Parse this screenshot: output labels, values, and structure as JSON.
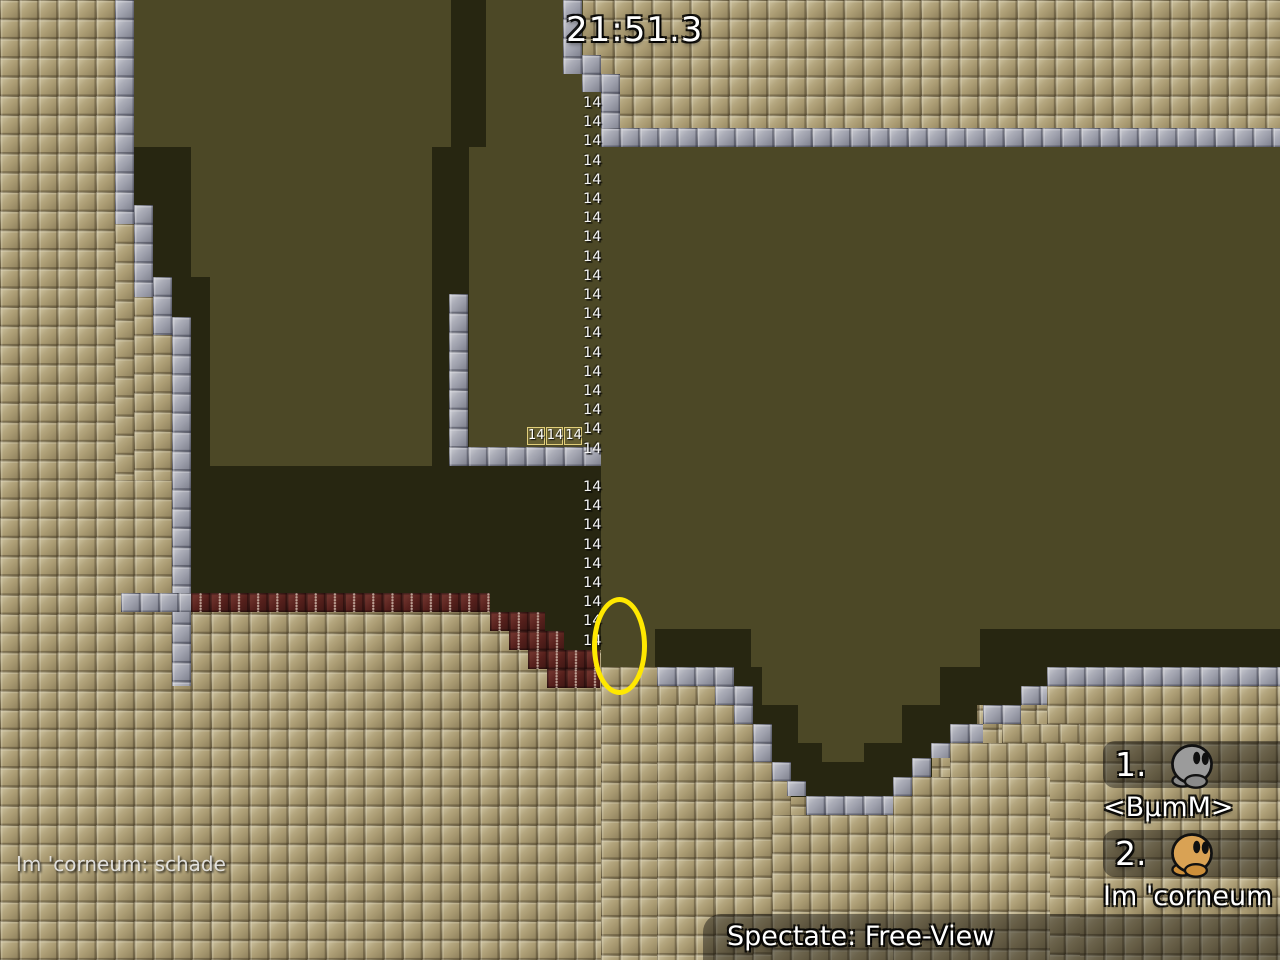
{
  "hud": {
    "timer": "21:51.3",
    "chat_message": "Im 'corneum: schade",
    "spectate_label": "Spectate: Free-View"
  },
  "scoreboard": {
    "entries": [
      {
        "rank": "1.",
        "name": "<BμmM>",
        "tee_color": "#9b9b9b",
        "tee_feet_color": "#8a8a8a"
      },
      {
        "rank": "2.",
        "name": "Im 'corneum",
        "tee_color": "#d9a254",
        "tee_feet_color": "#cd8f3a"
      }
    ]
  },
  "map": {
    "switch_number": "14",
    "switch_column_count": 28,
    "switch_box_values": [
      "14",
      "14",
      "14"
    ],
    "colors": {
      "ground": "#ac9d74",
      "unhookable": "#a0a2ae",
      "background": "#4c4826",
      "background_dark": "#272611",
      "freeze": "#56201c",
      "marker_yellow": "#ffe800"
    }
  }
}
